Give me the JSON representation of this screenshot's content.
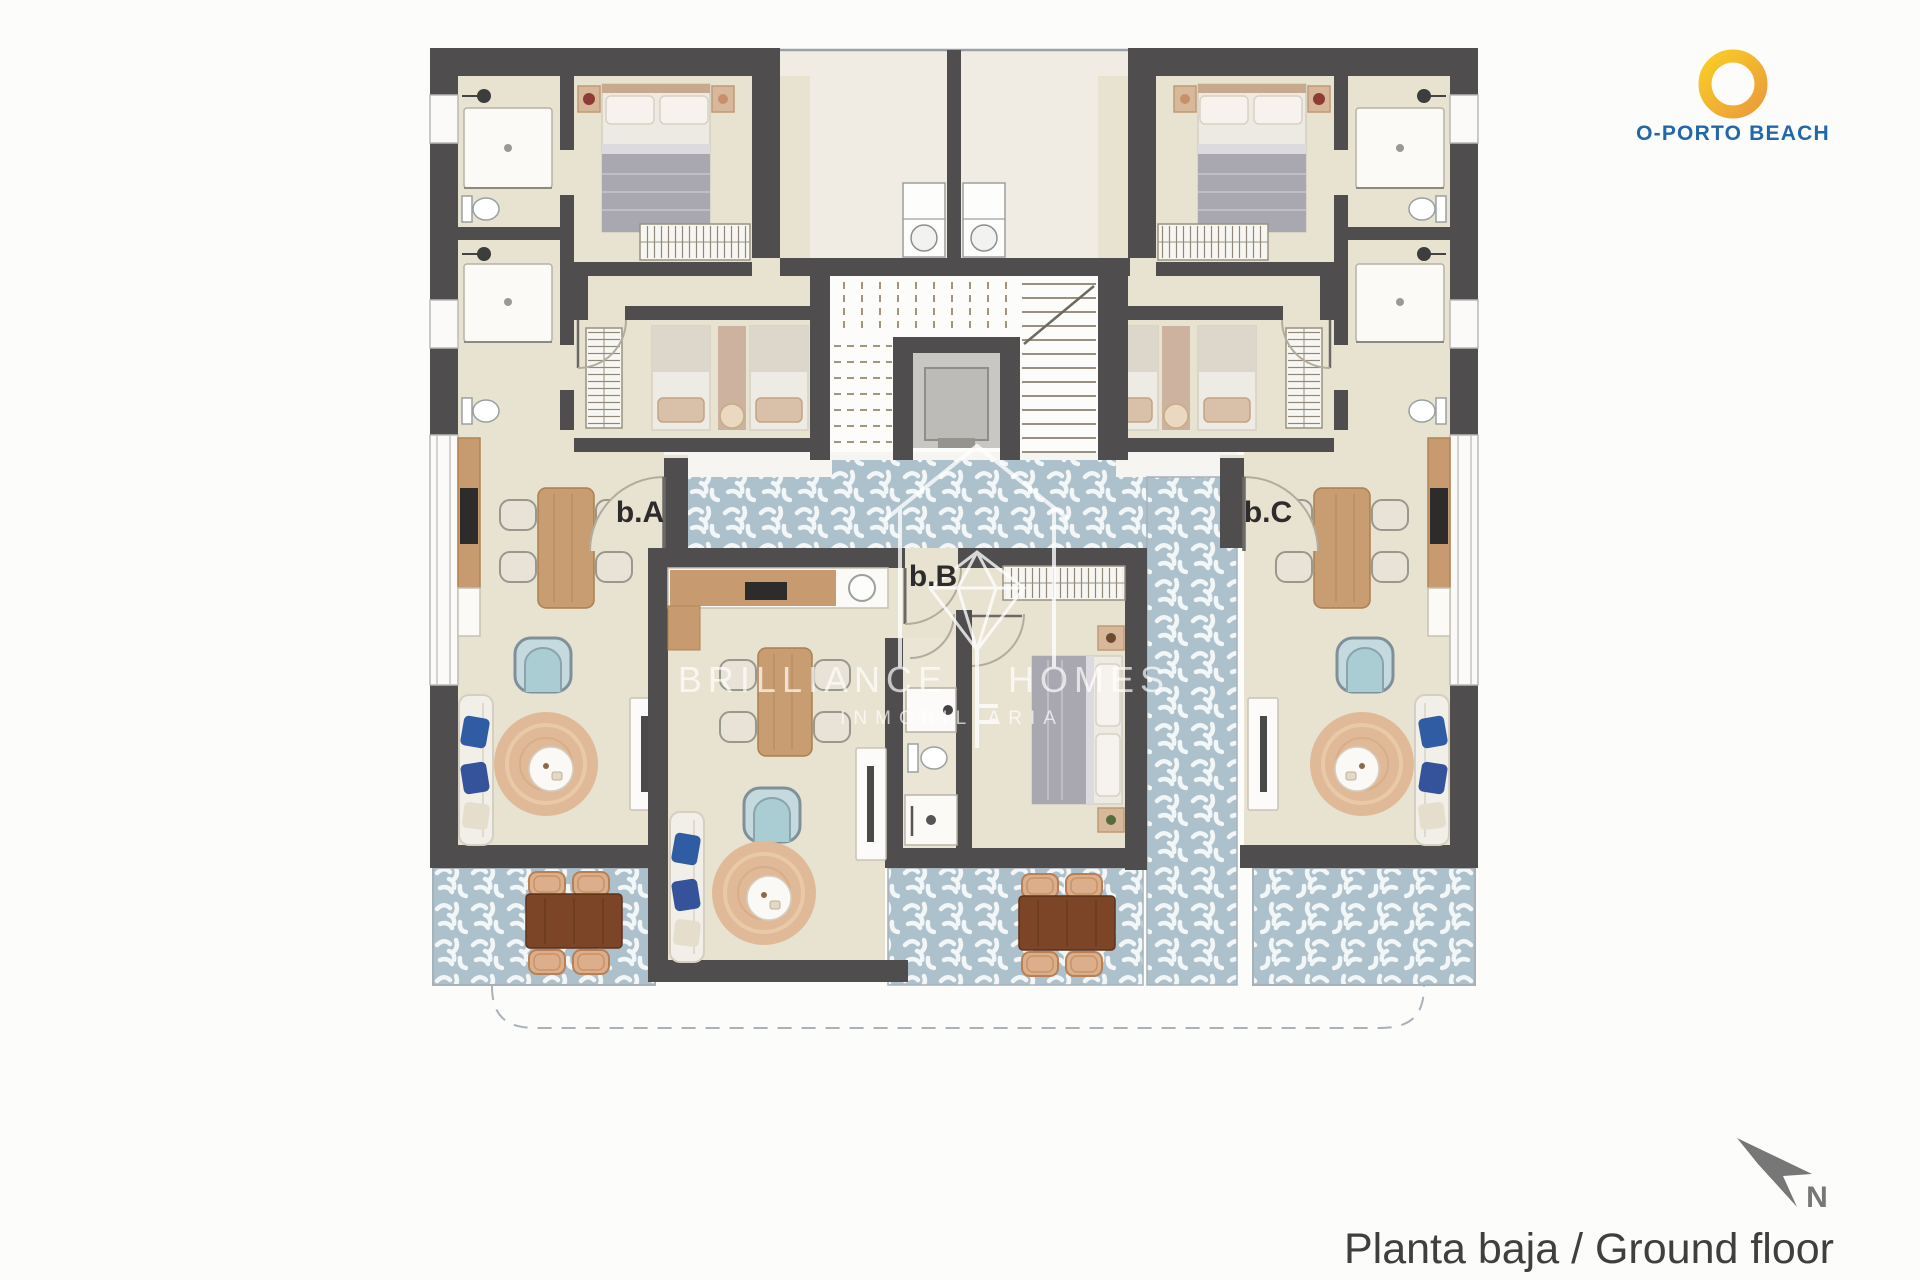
{
  "page": {
    "background": "#fcfcfb"
  },
  "branding": {
    "name": "O-PORTO BEACH",
    "text_color": "#2268a8",
    "ring_yellow": "#f9cd25",
    "ring_orange": "#eb9b3a"
  },
  "plan": {
    "labels": {
      "unit_a": "b.A",
      "unit_b": "b.B",
      "unit_c": "b.C"
    },
    "colors": {
      "wall": "#4f4d4e",
      "floor": "#e8e2d1",
      "patio": "#f0ece3",
      "terrace_base": "#adc1cc",
      "terrace_mark": "#f3f6f7",
      "wood": "#c79b6f",
      "outdoor_wood": "#7c4527",
      "blanket_gray": "#a9a7b0",
      "pillow_blue": "#2f5ca2",
      "armchair_blue": "#c5dade",
      "rug_tan": "#e0ba98"
    }
  },
  "watermark": {
    "brand_left": "BRILLIANCE",
    "brand_right": "HOMES",
    "subtitle": "INMOBILIARIA"
  },
  "compass": {
    "north_label": "N"
  },
  "footer": {
    "caption": "Planta baja / Ground floor",
    "color": "#3f3f3f"
  }
}
